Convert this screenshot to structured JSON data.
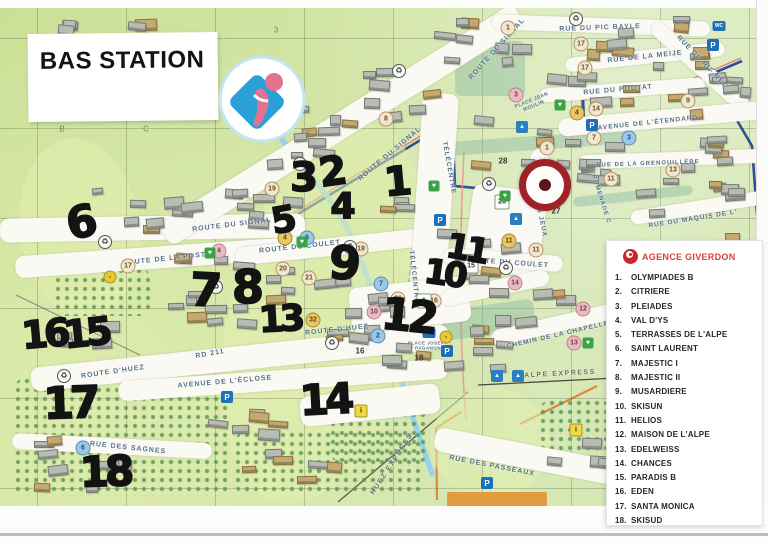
{
  "title": "BAS STATION",
  "legend": {
    "agency": "AGENCE GIVERDON",
    "items": [
      {
        "n": "1.",
        "label": "OLYMPIADES B"
      },
      {
        "n": "2.",
        "label": "CITRIERE"
      },
      {
        "n": "3.",
        "label": "PLEIADES"
      },
      {
        "n": "4.",
        "label": "VAL D'YS"
      },
      {
        "n": "5.",
        "label": "TERRASSES DE L'ALPE"
      },
      {
        "n": "6.",
        "label": "SAINT LAURENT"
      },
      {
        "n": "7.",
        "label": "MAJESTIC I"
      },
      {
        "n": "8.",
        "label": "MAJESTIC II"
      },
      {
        "n": "9.",
        "label": "MUSARDIERE"
      },
      {
        "n": "10.",
        "label": "SKISUN"
      },
      {
        "n": "11.",
        "label": "HELIOS"
      },
      {
        "n": "12.",
        "label": "MAISON DE L'ALPE"
      },
      {
        "n": "13.",
        "label": "EDELWEISS"
      },
      {
        "n": "14.",
        "label": "CHANCES"
      },
      {
        "n": "15.",
        "label": "PARADIS B"
      },
      {
        "n": "16.",
        "label": "EDEN"
      },
      {
        "n": "17.",
        "label": "SANTA MONICA"
      },
      {
        "n": "18.",
        "label": "SKISUD"
      }
    ]
  },
  "map": {
    "grid_labels": [
      {
        "t": "B",
        "x": 62,
        "y": 129
      },
      {
        "t": "C",
        "x": 146,
        "y": 129
      },
      {
        "t": "D",
        "x": 237,
        "y": 129
      },
      {
        "t": "E",
        "x": 309,
        "y": 134
      },
      {
        "t": "3",
        "x": 276,
        "y": 30
      }
    ],
    "streets": [
      {
        "t": "RUE DU PIC BAYLE",
        "x": 600,
        "y": 28,
        "r": -2,
        "s": 7
      },
      {
        "t": "RUE DE LA MEIJE",
        "x": 645,
        "y": 57,
        "r": -6,
        "s": 7
      },
      {
        "t": "RUE DU POUTAT",
        "x": 618,
        "y": 90,
        "r": -5,
        "s": 7
      },
      {
        "t": "RUE DU RIF NEL",
        "x": 702,
        "y": 62,
        "r": 46,
        "s": 7
      },
      {
        "t": "ROUTE DU SIGNAL",
        "x": 497,
        "y": 49,
        "r": -48,
        "s": 7
      },
      {
        "t": "ROUTE DU SIGNAL",
        "x": 390,
        "y": 154,
        "r": -40,
        "s": 7
      },
      {
        "t": "ROUTE DU SIGNAL",
        "x": 232,
        "y": 225,
        "r": -7,
        "s": 7
      },
      {
        "t": "AVENUE DE L'ÉTENDARD",
        "x": 648,
        "y": 123,
        "r": -6,
        "s": 6.5
      },
      {
        "t": "PLACE JEAN MOULIN",
        "x": 533,
        "y": 104,
        "r": -22,
        "s": 5,
        "w": 40
      },
      {
        "t": "RUE DE LA GRENOUILLÈRE",
        "x": 648,
        "y": 164,
        "r": -2,
        "s": 6
      },
      {
        "t": "RUE DU MAQUIS DE L'",
        "x": 693,
        "y": 219,
        "r": -9,
        "s": 6.5
      },
      {
        "t": "PROMENADE C",
        "x": 600,
        "y": 197,
        "r": 72,
        "s": 6
      },
      {
        "t": "AVENUE DES JEUX",
        "x": 537,
        "y": 200,
        "r": 78,
        "s": 6.5
      },
      {
        "t": "TÉLÉCENTRE",
        "x": 449,
        "y": 168,
        "r": 80,
        "s": 6.5
      },
      {
        "t": "TÉLÉCENTRE",
        "x": 414,
        "y": 277,
        "r": 84,
        "s": 6.5
      },
      {
        "t": "ROUTE DE LA POSTE",
        "x": 167,
        "y": 259,
        "r": -6,
        "s": 7
      },
      {
        "t": "ROUTE DU COULET",
        "x": 300,
        "y": 247,
        "r": -6,
        "s": 7
      },
      {
        "t": "ROUTE DU COULET",
        "x": 508,
        "y": 263,
        "r": 4,
        "s": 7
      },
      {
        "t": "ROUTE D'HUEZ",
        "x": 113,
        "y": 372,
        "r": -8,
        "s": 7
      },
      {
        "t": "ROUTE D'HUEZ",
        "x": 337,
        "y": 330,
        "r": -6,
        "s": 7
      },
      {
        "t": "RD 211",
        "x": 210,
        "y": 354,
        "r": -10,
        "s": 7
      },
      {
        "t": "AVENUE DE L'ÉCLOSE",
        "x": 225,
        "y": 382,
        "r": -5,
        "s": 7
      },
      {
        "t": "RUE DES SAGNES",
        "x": 128,
        "y": 448,
        "r": 6,
        "s": 7
      },
      {
        "t": "CHEMIN DE LA CHAPELLE",
        "x": 558,
        "y": 335,
        "r": -13,
        "s": 6.5
      },
      {
        "t": "RUE DES PASSEAUX",
        "x": 492,
        "y": 466,
        "r": 11,
        "s": 7
      },
      {
        "t": "PLACE JOSEPH PAGANON",
        "x": 428,
        "y": 346,
        "r": 0,
        "s": 4.6,
        "w": 44
      },
      {
        "t": "ALPE EXPRESS",
        "x": 560,
        "y": 374,
        "r": -3,
        "s": 7,
        "lift": true
      },
      {
        "t": "HUEZ EXPRESS",
        "x": 392,
        "y": 464,
        "r": -57,
        "s": 7,
        "lift": true
      }
    ],
    "hand_numbers": [
      {
        "t": "1",
        "x": 398,
        "y": 182,
        "s": 40,
        "r": -5
      },
      {
        "t": "2",
        "x": 333,
        "y": 172,
        "s": 40,
        "r": -8
      },
      {
        "t": "3",
        "x": 304,
        "y": 178,
        "s": 40,
        "r": 0
      },
      {
        "t": "4",
        "x": 343,
        "y": 207,
        "s": 36,
        "r": 0
      },
      {
        "t": "5",
        "x": 284,
        "y": 221,
        "s": 36,
        "r": -10
      },
      {
        "t": "6",
        "x": 82,
        "y": 223,
        "s": 44,
        "r": -12
      },
      {
        "t": "7",
        "x": 206,
        "y": 290,
        "s": 46,
        "r": 3
      },
      {
        "t": "8",
        "x": 248,
        "y": 287,
        "s": 46,
        "r": 0
      },
      {
        "t": "9",
        "x": 345,
        "y": 263,
        "s": 46,
        "r": 5
      },
      {
        "t": "10",
        "x": 444,
        "y": 274,
        "s": 34,
        "r": 8
      },
      {
        "t": "11",
        "x": 466,
        "y": 249,
        "s": 34,
        "r": 10
      },
      {
        "t": "12",
        "x": 408,
        "y": 317,
        "s": 44,
        "r": 6
      },
      {
        "t": "13",
        "x": 280,
        "y": 320,
        "s": 36,
        "r": -3
      },
      {
        "t": "14",
        "x": 325,
        "y": 400,
        "s": 42,
        "r": -3
      },
      {
        "t": "15",
        "x": 86,
        "y": 333,
        "s": 38,
        "r": -6
      },
      {
        "t": "16",
        "x": 44,
        "y": 334,
        "s": 38,
        "r": -5
      },
      {
        "t": "17",
        "x": 70,
        "y": 404,
        "s": 44,
        "r": -2
      },
      {
        "t": "18",
        "x": 105,
        "y": 472,
        "s": 42,
        "r": -2
      }
    ],
    "markers": [
      {
        "t": "19",
        "x": 272,
        "y": 189,
        "style": "beige"
      },
      {
        "t": "19",
        "x": 361,
        "y": 249,
        "style": "beige"
      },
      {
        "t": "17",
        "x": 128,
        "y": 266,
        "style": "beige"
      },
      {
        "t": "20",
        "x": 283,
        "y": 269,
        "style": "beige"
      },
      {
        "t": "21",
        "x": 309,
        "y": 278,
        "style": "beige"
      },
      {
        "t": "17",
        "x": 581,
        "y": 44,
        "style": "beige"
      },
      {
        "t": "17",
        "x": 585,
        "y": 68,
        "style": "beige"
      },
      {
        "t": "8",
        "x": 386,
        "y": 119,
        "style": "beige"
      },
      {
        "t": "9",
        "x": 688,
        "y": 101,
        "style": "beige"
      },
      {
        "t": "14",
        "x": 596,
        "y": 109,
        "style": "beige"
      },
      {
        "t": "11",
        "x": 536,
        "y": 250,
        "style": "beige"
      },
      {
        "t": "16",
        "x": 434,
        "y": 301,
        "style": "beige"
      },
      {
        "t": "1",
        "x": 547,
        "y": 148,
        "style": "beige"
      },
      {
        "t": "1",
        "x": 508,
        "y": 28,
        "style": "beige"
      },
      {
        "t": "7",
        "x": 594,
        "y": 138,
        "style": "beige"
      },
      {
        "t": "36",
        "x": 398,
        "y": 299,
        "style": "beige"
      },
      {
        "t": "13",
        "x": 673,
        "y": 170,
        "style": "beige"
      },
      {
        "t": "11",
        "x": 611,
        "y": 179,
        "style": "beige"
      },
      {
        "t": "32",
        "x": 313,
        "y": 320,
        "style": "gold"
      },
      {
        "t": "4",
        "x": 285,
        "y": 238,
        "style": "gold"
      },
      {
        "t": "4",
        "x": 577,
        "y": 113,
        "style": "gold"
      },
      {
        "t": "11",
        "x": 509,
        "y": 241,
        "style": "gold"
      },
      {
        "t": "3",
        "x": 516,
        "y": 95,
        "style": "pink"
      },
      {
        "t": "14",
        "x": 515,
        "y": 283,
        "style": "pink"
      },
      {
        "t": "12",
        "x": 583,
        "y": 309,
        "style": "pink"
      },
      {
        "t": "13",
        "x": 574,
        "y": 343,
        "style": "pink"
      },
      {
        "t": "10",
        "x": 374,
        "y": 312,
        "style": "pink"
      },
      {
        "t": "4",
        "x": 219,
        "y": 251,
        "style": "pink"
      },
      {
        "t": "6",
        "x": 307,
        "y": 238,
        "style": "blue"
      },
      {
        "t": "6",
        "x": 83,
        "y": 448,
        "style": "blue"
      },
      {
        "t": "2",
        "x": 378,
        "y": 336,
        "style": "blue"
      },
      {
        "t": "3",
        "x": 629,
        "y": 138,
        "style": "blue"
      },
      {
        "t": "7",
        "x": 381,
        "y": 284,
        "style": "blue"
      },
      {
        "t": "26",
        "x": 502,
        "y": 202,
        "style": "whitebox"
      },
      {
        "t": "15",
        "x": 471,
        "y": 266,
        "style": "whitebox"
      },
      {
        "t": "1",
        "x": 424,
        "y": 301,
        "style": "whitebox"
      },
      {
        "t": "27",
        "x": 556,
        "y": 211,
        "style": "plain"
      },
      {
        "t": "28",
        "x": 503,
        "y": 161,
        "style": "plain"
      },
      {
        "t": "16",
        "x": 360,
        "y": 351,
        "style": "plain"
      },
      {
        "t": "18",
        "x": 419,
        "y": 358,
        "style": "plain"
      }
    ],
    "icons": {
      "parking": [
        {
          "x": 713,
          "y": 45
        },
        {
          "x": 592,
          "y": 125
        },
        {
          "x": 440,
          "y": 220
        },
        {
          "x": 447,
          "y": 351
        },
        {
          "x": 227,
          "y": 397
        },
        {
          "x": 487,
          "y": 483
        }
      ],
      "wc": [
        {
          "x": 719,
          "y": 26
        },
        {
          "x": 429,
          "y": 333
        }
      ],
      "recycle": [
        {
          "x": 399,
          "y": 71
        },
        {
          "x": 576,
          "y": 19
        },
        {
          "x": 489,
          "y": 184
        },
        {
          "x": 660,
          "y": 291
        },
        {
          "x": 105,
          "y": 242
        },
        {
          "x": 216,
          "y": 287
        },
        {
          "x": 300,
          "y": 164
        },
        {
          "x": 506,
          "y": 268
        },
        {
          "x": 332,
          "y": 343
        },
        {
          "x": 64,
          "y": 376
        },
        {
          "x": 350,
          "y": 247
        }
      ],
      "park_heart": [
        {
          "x": 210,
          "y": 253
        },
        {
          "x": 302,
          "y": 242
        },
        {
          "x": 505,
          "y": 196
        },
        {
          "x": 588,
          "y": 343
        },
        {
          "x": 560,
          "y": 105
        },
        {
          "x": 434,
          "y": 186
        }
      ],
      "bus": [
        {
          "x": 446,
          "y": 337
        },
        {
          "x": 110,
          "y": 277
        }
      ],
      "info_yellow": [
        {
          "x": 361,
          "y": 411
        },
        {
          "x": 576,
          "y": 430
        }
      ],
      "activity_blue": [
        {
          "x": 497,
          "y": 376
        },
        {
          "x": 518,
          "y": 376
        },
        {
          "x": 522,
          "y": 127
        },
        {
          "x": 516,
          "y": 219
        }
      ]
    },
    "colors": {
      "accent_red": "#d94040",
      "marker_ring_red": "#9e2227",
      "road_blue": "#2f4f96",
      "piste_blue": "#8fd0ee",
      "map_green": "#cfe29c",
      "hand_black": "#131313"
    }
  }
}
